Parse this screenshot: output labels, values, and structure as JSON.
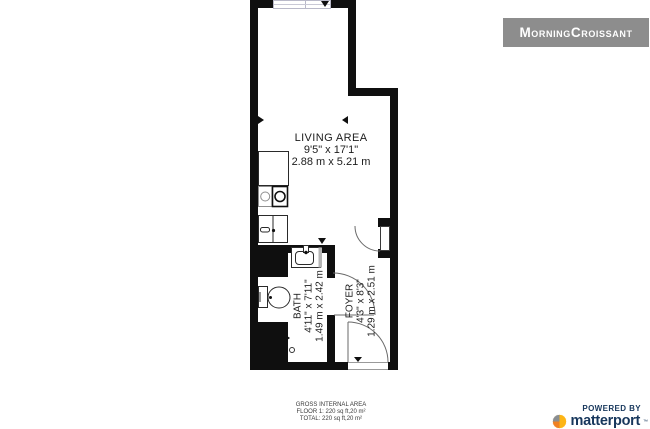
{
  "branding": {
    "watermark": "MorningCroissant",
    "powered_by": "POWERED BY",
    "brand_name": "matterport",
    "trademark": "™"
  },
  "rooms": {
    "living": {
      "name": "LIVING AREA",
      "imperial": "9'5\" x 17'1\"",
      "metric": "2.88 m x 5.21 m"
    },
    "bath": {
      "name": "BATH",
      "imperial": "4'11\" x 7'11\"",
      "metric": "1.49 m x 2.42 m"
    },
    "foyer": {
      "name": "FOYER",
      "imperial": "4'3\" x 8'3\"",
      "metric": "1.29 m x 2.51 m"
    }
  },
  "footer": {
    "title": "GROSS INTERNAL AREA",
    "floor_line": "FLOOR 1: 220 sq ft,20 m²",
    "total_line": "TOTAL: 220 sq ft,20 m²"
  },
  "colors": {
    "wall": "#0f0f0f",
    "banner_bg": "#8d8d8d",
    "banner_text": "#ffffff",
    "brand_navy": "#17375c",
    "brand_orange": "#ef8022",
    "brand_yellow": "#fdb515",
    "brand_gray": "#8a8e91",
    "window_frame": "#b9b9c9"
  }
}
